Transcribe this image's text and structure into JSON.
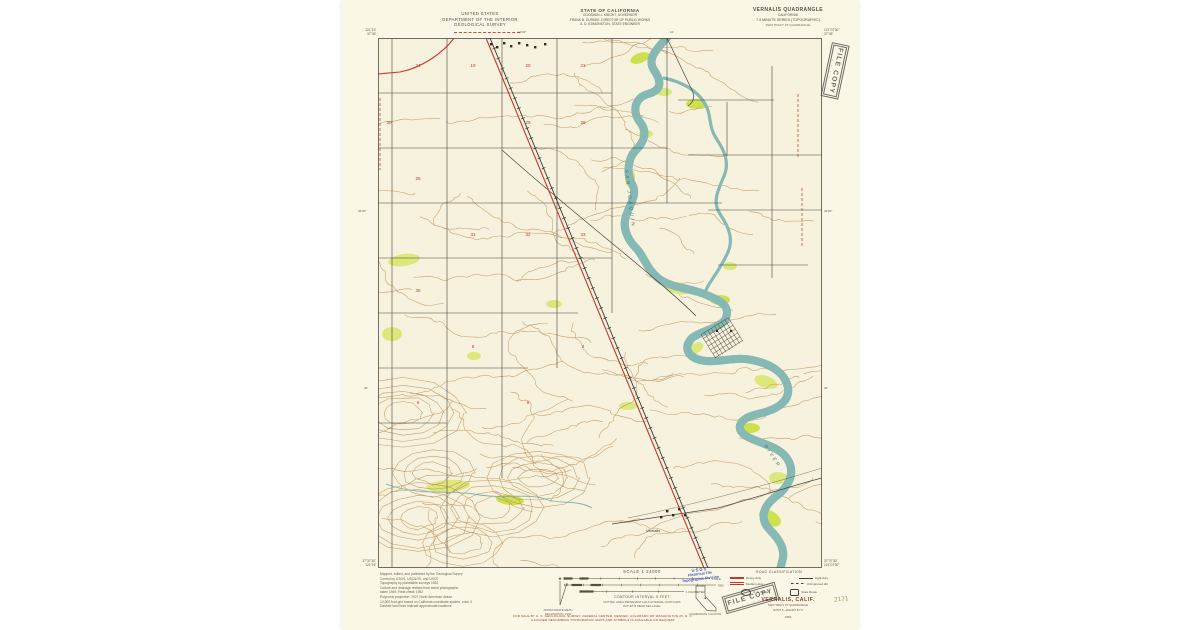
{
  "header": {
    "agency_lines": [
      "UNITED STATES",
      "DEPARTMENT OF THE INTERIOR",
      "GEOLOGICAL SURVEY"
    ],
    "state_lines": [
      "STATE OF CALIFORNIA",
      "GOODWIN J. KNIGHT, GOVERNOR",
      "FRANK B. DURKEE, DIRECTOR OF PUBLIC WORKS",
      "A. D. EDMONSTON, STATE ENGINEER"
    ],
    "quad_lines": [
      "VERNALIS QUADRANGLE",
      "CALIFORNIA",
      "7.5 MINUTE SERIES (TOPOGRAPHIC)",
      "SW/4 TRACY 15' QUADRANGLE"
    ]
  },
  "map": {
    "corner_coords": {
      "top_left_lon": "121°15'",
      "top_left_lat": "37°45'",
      "top_right_lon": "121°07'30\"",
      "top_right_lat": "37°45'",
      "bottom_left_lat": "37°37'30\"",
      "bottom_left_lon": "121°15'",
      "bottom_right_lat": "37°37'30\"",
      "bottom_right_lon": "121°07'30\""
    },
    "edge_ticks": {
      "top": [
        "12'30\"",
        "10'"
      ],
      "left": [
        "42'30\"",
        "40'"
      ],
      "right": [
        "42'30\"",
        "40'"
      ]
    },
    "river_label_upper": "SAN JOAQUIN",
    "river_label_lower": "RIVER",
    "town_label": "Vernalis",
    "section_numbers": [
      {
        "n": "24",
        "x": 40,
        "y": 29
      },
      {
        "n": "19",
        "x": 95,
        "y": 29
      },
      {
        "n": "20",
        "x": 150,
        "y": 29
      },
      {
        "n": "21",
        "x": 205,
        "y": 29
      },
      {
        "n": "30",
        "x": 11,
        "y": 86
      },
      {
        "n": "29",
        "x": 150,
        "y": 86
      },
      {
        "n": "28",
        "x": 205,
        "y": 86
      },
      {
        "n": "25",
        "x": 40,
        "y": 142
      },
      {
        "n": "31",
        "x": 95,
        "y": 198
      },
      {
        "n": "32",
        "x": 150,
        "y": 198
      },
      {
        "n": "33",
        "x": 205,
        "y": 198
      },
      {
        "n": "36",
        "x": 40,
        "y": 254
      },
      {
        "n": "5",
        "x": 95,
        "y": 310
      },
      {
        "n": "4",
        "x": 205,
        "y": 310
      },
      {
        "n": "6",
        "x": 40,
        "y": 366
      },
      {
        "n": "8",
        "x": 150,
        "y": 366
      }
    ],
    "colors": {
      "paper": "#fbf7e6",
      "map_bg": "#f7f2dd",
      "contour": "#b5874e",
      "water_fill": "#bfdfdb",
      "water_edge": "#86b8b4",
      "vegetation": "#dce77c",
      "road_red": "#c2392c",
      "grid_black": "#46423c",
      "section_red": "#c0392b"
    }
  },
  "footer": {
    "credits": [
      "Mapped, edited, and published by the Geological Survey",
      "Control by USGS, USC&GS, and USCE",
      "Topography by planetable surveys 1952",
      "Culture and drainage revised from aerial photographs",
      "taken 1949. Field check 1952",
      "Polyconic projection. 1927 North American datum",
      "10,000-foot grid based on California coordinate system, zone 3",
      "Dashed land lines indicate approximate locations"
    ],
    "declination_lines": [
      "APPROXIMATE MEAN",
      "DECLINATION, 1952"
    ],
    "scale_label": "SCALE 1:24000",
    "scale_bar_labels": [
      "1 MILE",
      "7000 FEET",
      "1 KILOMETER"
    ],
    "contour_note_lines": [
      "CONTOUR INTERVAL 5 FEET",
      "DOTTED LINES REPRESENT HALF-INTERVAL CONTOURS",
      "DATUM IS MEAN SEA LEVEL"
    ],
    "blue_stamp_lines": [
      "USGS",
      "Historical File",
      "Topographic Division"
    ],
    "quadrangle_location_label": "QUADRANGLE LOCATION",
    "road_classification": {
      "title": "ROAD CLASSIFICATION",
      "heavy": "Heavy-duty",
      "light": "Light-duty",
      "medium": "Medium-duty",
      "unimproved": "Unimproved dirt",
      "us_route": "U. S. Route",
      "state_route": "State Route"
    },
    "sheet_name": "VERNALIS, CALIF.",
    "sheet_sub_lines": [
      "SW/4 TRACY 15' QUADRANGLE",
      "N3737.5—W12107.5/7.5"
    ],
    "sheet_year": "1952",
    "sale_lines": [
      "FOR SALE BY U. S. GEOLOGICAL SURVEY, FEDERAL CENTER, DENVER, COLORADO OR WASHINGTON 25, D. C.",
      "A FOLDER DESCRIBING TOPOGRAPHIC MAPS AND SYMBOLS IS AVAILABLE ON REQUEST"
    ],
    "file_copy_stamp": "FILE COPY",
    "file_copy_stars": "* * * *",
    "pencil_note": "2171"
  }
}
